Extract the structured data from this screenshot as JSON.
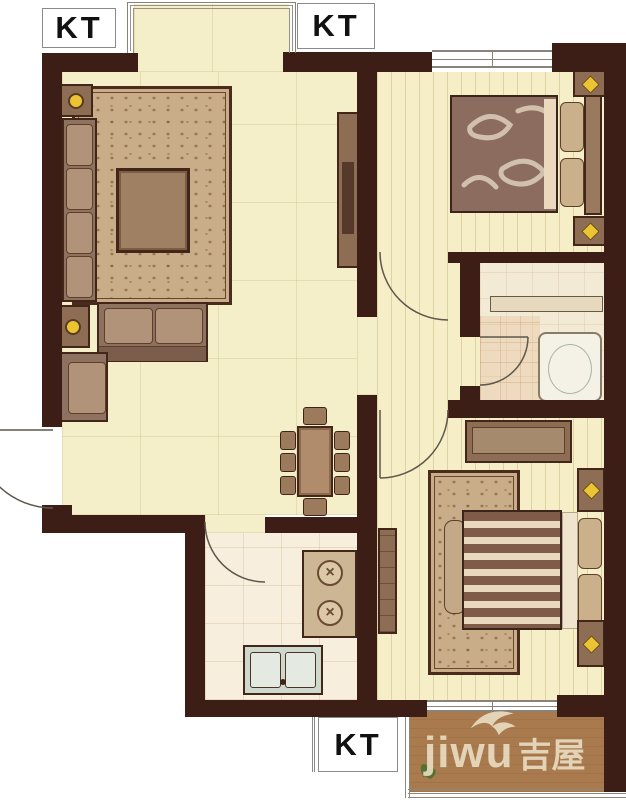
{
  "labels": {
    "kt_top_left": "KT",
    "kt_top_center": "KT",
    "kt_bottom": "KT"
  },
  "watermark": {
    "latin": "jiwu",
    "cjk": "吉屋",
    "logo_icon": "bird-logo-icon",
    "text_color": "#ece0c6"
  },
  "colors": {
    "wall": "#3d1e16",
    "living_floor": "#f4eec9",
    "bedroom_floor": "#f5eec6",
    "kitchen_floor": "#f8eedd",
    "bathroom_floor": "#f3ead6",
    "balcony_floor": "#a87a4e",
    "rug": "#c9ac88",
    "furniture": "#8d6e55",
    "lamp_accent": "#eac433",
    "kt_text": "#111111"
  },
  "icons": [
    "lamp-icon",
    "star-lamp-icon",
    "bird-logo-icon",
    "plant-icon",
    "stove-burner-icon",
    "door-swing-arc",
    "window-symbol"
  ]
}
